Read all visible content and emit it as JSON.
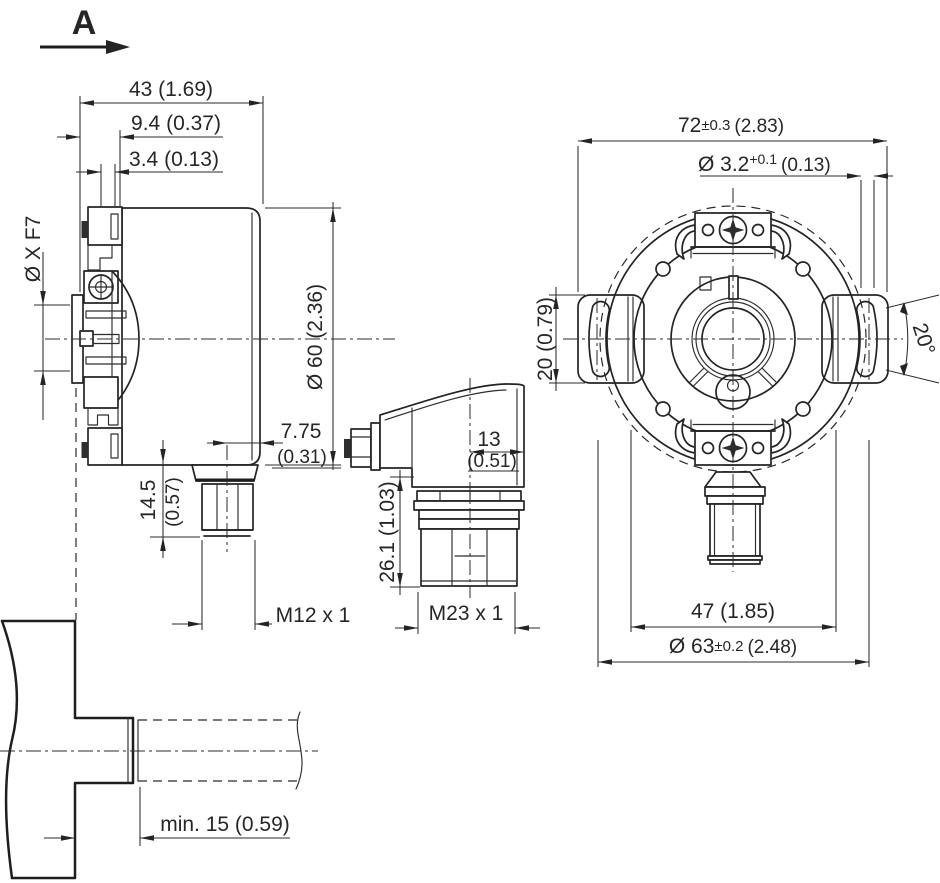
{
  "view_arrow": {
    "label": "A"
  },
  "side_view": {
    "depth": "43 (1.69)",
    "step1": "9.4 (0.37)",
    "step2": "3.4 (0.13)",
    "bore": "Ø X F7",
    "housing_diameter": "Ø 60 (2.36)",
    "connector_offset_mm": "7.75",
    "connector_offset_inch": "(0.31)",
    "connector_height_mm": "14.5",
    "connector_height_inch": "(0.57)",
    "connector_thread": "M12 x 1"
  },
  "cable_connector_view": {
    "width_mm": "13",
    "width_inch": "(0.51)",
    "height": "26.1 (1.03)",
    "thread": "M23 x 1"
  },
  "front_view": {
    "mounting_width_value": "72",
    "mounting_width_tolerance": "±0.3",
    "mounting_width_inch": "(2.83)",
    "hole_value": "Ø 3.2",
    "hole_tolerance": "+0.1",
    "hole_inch": "(0.13)",
    "tab_height": "20 (0.79)",
    "slot_angle": "20°",
    "clamp_spacing": "47 (1.85)",
    "outer_diameter_value": "Ø 63",
    "outer_diameter_tolerance": "±0.2",
    "outer_diameter_inch": "(2.48)"
  },
  "shaft_mounting_view": {
    "min_insertion": "min. 15 (0.59)"
  }
}
